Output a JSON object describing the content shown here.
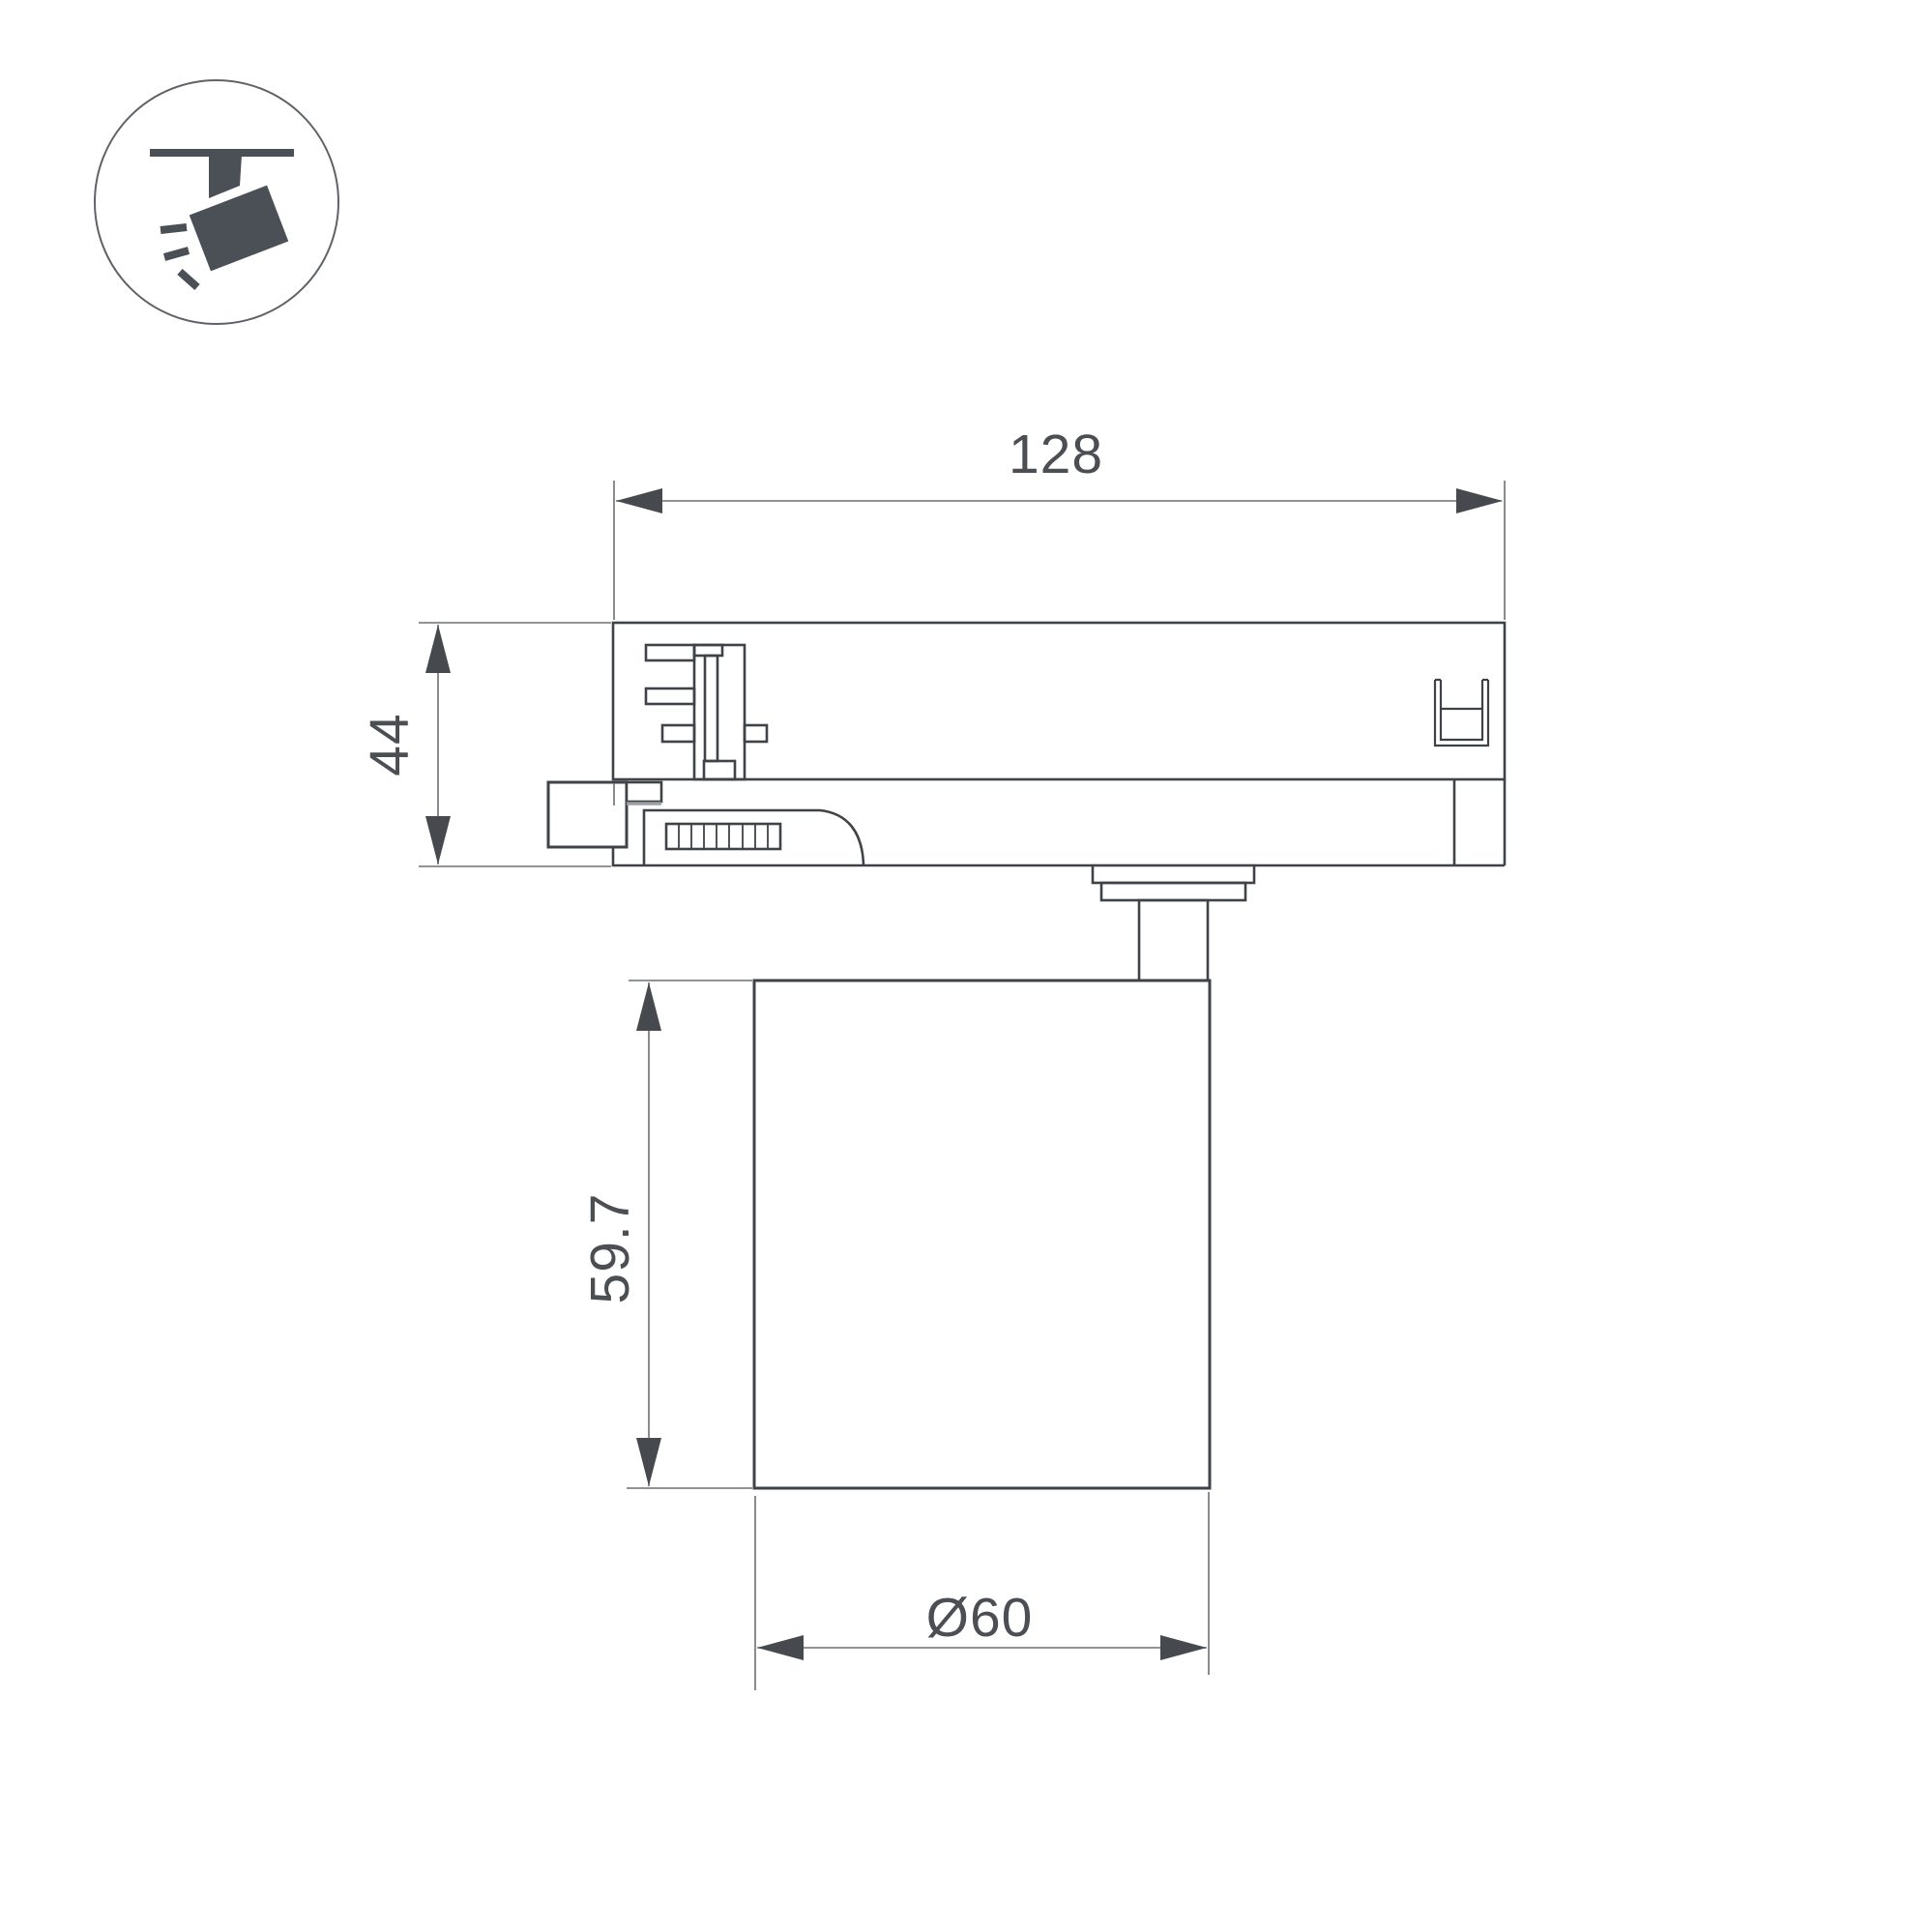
{
  "page": {
    "background": "#ffffff",
    "kind": "technical dimension drawing of a track-mounted spotlight (side view)"
  },
  "icon": {
    "name": "ceiling-track-spotlight",
    "color": "#4a5056",
    "circle_stroke": "#5f6368"
  },
  "drawing": {
    "colors": {
      "outline": "#3f4347",
      "dimension_line": "#6d7074",
      "arrow": "#46494e",
      "text": "#4b4f54"
    },
    "dimensions": {
      "adapter_width": {
        "label": "128"
      },
      "adapter_height": {
        "label": "44"
      },
      "body_height": {
        "label": "59.7"
      },
      "body_diameter": {
        "label": "Ø60"
      }
    }
  }
}
